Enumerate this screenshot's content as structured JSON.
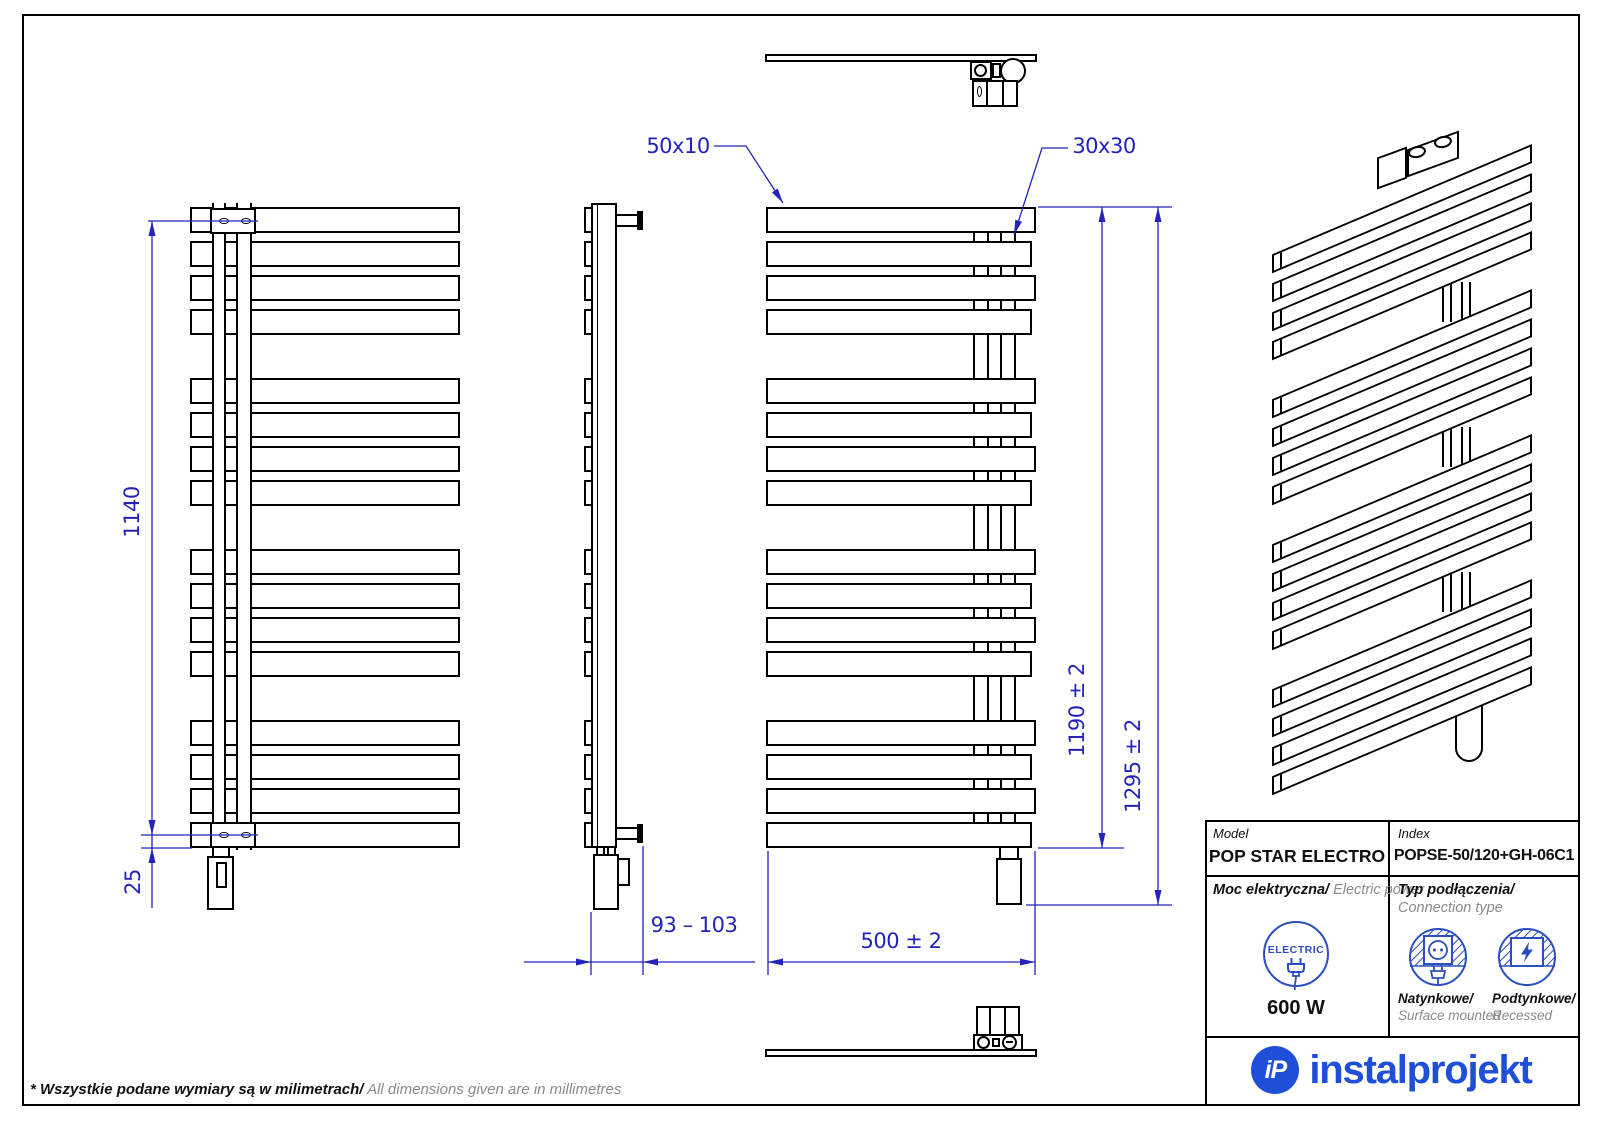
{
  "page": {
    "note_pl": "* Wszystkie podane wymiary są w milimetrach/",
    "note_en": "All dimensions given are in millimetres"
  },
  "colors": {
    "line": "#000000",
    "dim": "#2323bb",
    "brand": "#1f4fd8",
    "icon": "#2b4fbe",
    "muted": "#8a8a8a",
    "text": "#111111"
  },
  "dimensions": {
    "mount_height": "1140",
    "bottom_offset": "25",
    "depth_range": "93 – 103",
    "width": "500 ± 2",
    "height_body": "1190 ± 2",
    "height_total": "1295 ± 2",
    "bar_profile": "50x10",
    "collector_profile": "30x30"
  },
  "title_block": {
    "model_label": "Model",
    "model_value": "POP STAR ELECTRO",
    "index_label": "Index",
    "index_value": "POPSE-50/120+GH-06C1",
    "power_label_pl": "Moc elektryczna/",
    "power_label_en": "Electric power",
    "electric_badge": "ELECTRIC",
    "power_value": "600 W",
    "connection_label_pl": "Typ podłączenia/",
    "connection_label_en": "Connection type",
    "surface_pl": "Natynkowe/",
    "surface_en": "Surface mounted",
    "recessed_pl": "Podtynkowe/",
    "recessed_en": "Recessed",
    "brand_monogram": "iP",
    "brand": "instalprojekt"
  },
  "drawing": {
    "groups": 4,
    "bars_per_group": 4
  }
}
